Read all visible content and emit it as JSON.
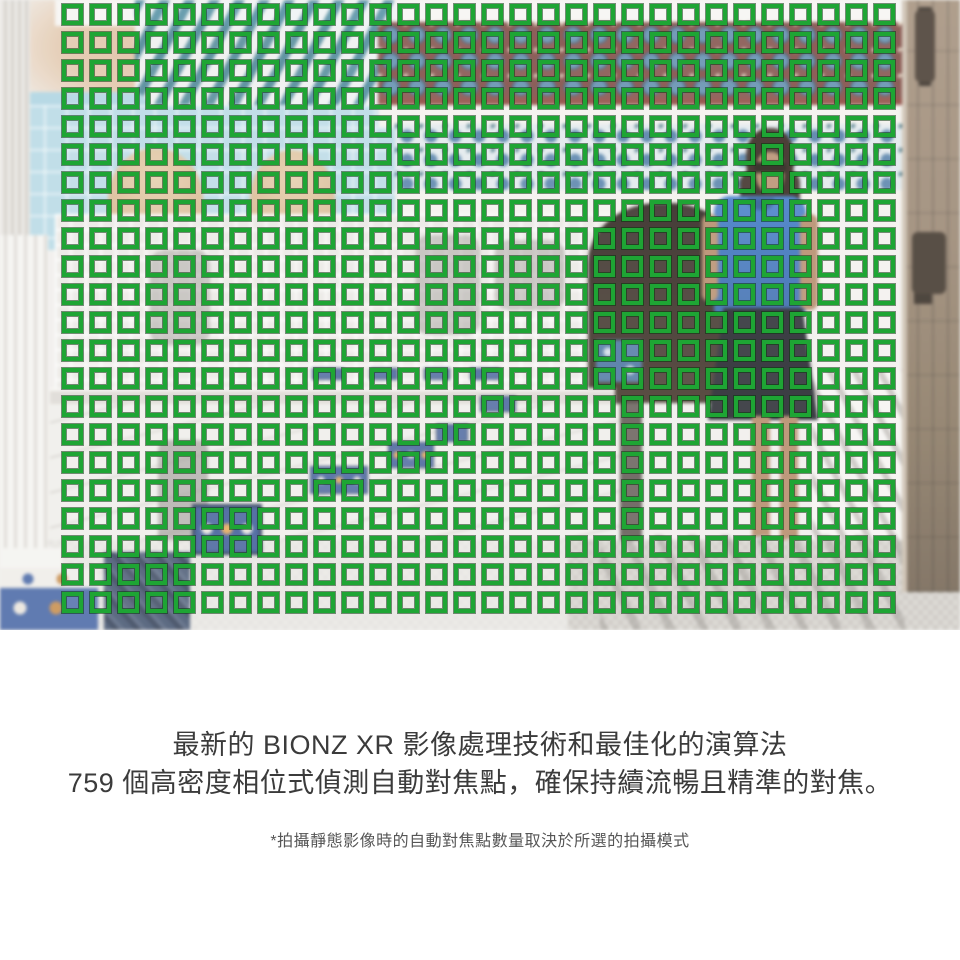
{
  "caption": {
    "line1": "最新的 BIONZ XR 影像處理技術和最佳化的演算法",
    "line2": "759 個高密度相位式偵測自動對焦點，確保持續流暢且精準的對焦。",
    "footnote": "*拍攝靜態影像時的自動對焦點數量取決於所選的拍攝模式",
    "text_color": "#3b3b3b",
    "footnote_color": "#565656"
  },
  "af_overlay": {
    "columns": 30,
    "rows": 22,
    "point_color": "#1ea534",
    "point_edge_color": "#07380c",
    "points_shown": 660
  },
  "photo": {
    "description_elements": {
      "person": "woman in blue top and dark skirt standing in archway",
      "left": "white fluted column with blue tiled pedestal",
      "right": "weathered wooden door with metal hardware",
      "wall": "blue and red moroccan mosaic tile bands",
      "middle": "white staircase with blue tiled risers"
    }
  }
}
